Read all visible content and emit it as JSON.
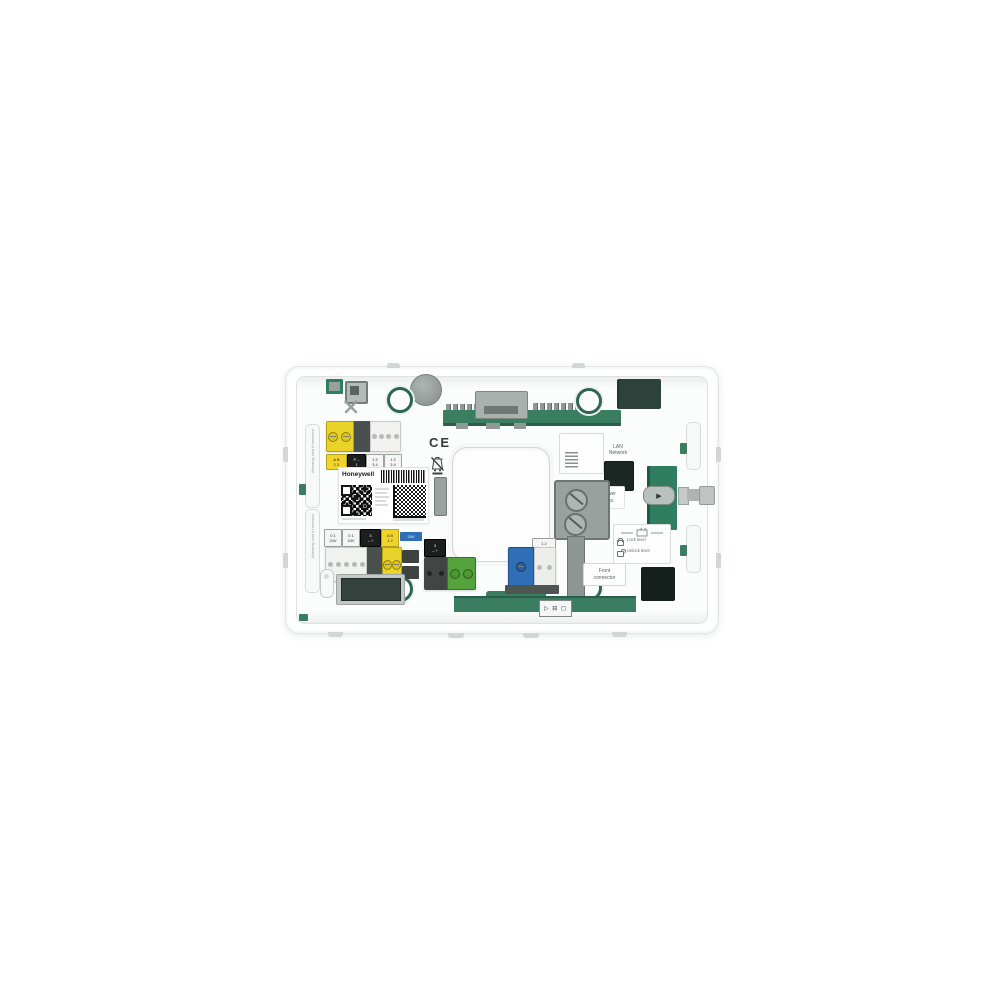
{
  "scene": {
    "background": "#ffffff"
  },
  "device": {
    "brand_label": "Honeywell",
    "ce_mark": "CE",
    "lan_port_label": [
      "LAN",
      "Network"
    ],
    "power_label": [
      "2nd Power",
      "12A Max."
    ],
    "front_connector_label": [
      "Front",
      "connector"
    ],
    "legend": {
      "lock": "Lock level",
      "unlock": "Unlock level"
    },
    "warranty_strip_top": "Warranty void if removed",
    "warranty_strip_bottom": "Warranty void if removed",
    "bottom_symbols": "▷ ⊟ ◻",
    "icons": {
      "arrow_right": "▶"
    },
    "stickers_top": [
      {
        "style": "yellow",
        "lines": [
          "A B",
          "1 2"
        ]
      },
      {
        "style": "black",
        "lines": [
          "P –",
          "1"
        ]
      },
      {
        "style": "white",
        "lines": [
          "1 2",
          "3 4"
        ]
      },
      {
        "style": "white",
        "lines": [
          "1 2",
          "3 4"
        ]
      }
    ],
    "stickers_bottom": [
      {
        "style": "white",
        "lines": [
          "0 1",
          "24V"
        ]
      },
      {
        "style": "white",
        "lines": [
          "0 1",
          "24V"
        ]
      },
      {
        "style": "black",
        "lines": [
          "3",
          "– +"
        ]
      },
      {
        "style": "yellow",
        "lines": [
          "A B",
          "1 2"
        ]
      }
    ],
    "blue_mini_label": "24V",
    "green_block_label": {
      "lines": [
        "3",
        "– +"
      ]
    },
    "blue_terminal_label": "1 2",
    "colors": {
      "pcb_green": "#3a7d61",
      "dark_green_block": "#2c423a",
      "terminal_yellow": "#e9d22a",
      "terminal_dark": "#4a504e",
      "terminal_blue": "#2f6fb8",
      "terminal_green": "#55a33c",
      "screw_ring_green": "#2d6654",
      "port_dark": "#1b2722"
    }
  }
}
